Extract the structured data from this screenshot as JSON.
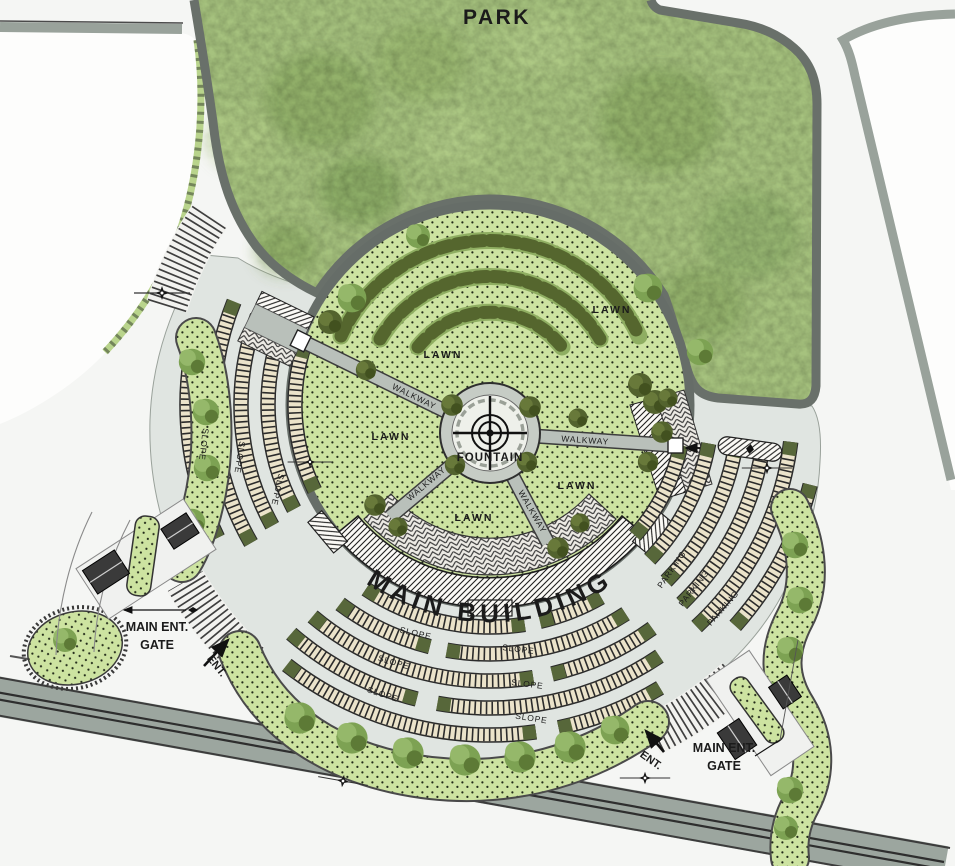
{
  "labels": {
    "park": "PARK",
    "lawn": "LAWN",
    "walkway": "WALKWAY",
    "fountain": "FOUNTAIN",
    "main_building": "MAIN BUILDING",
    "slope": "SLOPE",
    "parking": "PARKING",
    "ent": "ENT.",
    "main_ent_line1": "MAIN ENT.",
    "main_ent_line2": "GATE"
  },
  "colors": {
    "park_green": "#a6c27e",
    "stipple_lawn_green": "#cde3a1",
    "plaza_gray": "#e0e5e1",
    "road_gray": "#9ca69f",
    "border_gray": "#69706a",
    "hedge_green": "#57673a",
    "parking_stall_beige": "#ebe3ca",
    "ink": "#1b1b1b"
  }
}
